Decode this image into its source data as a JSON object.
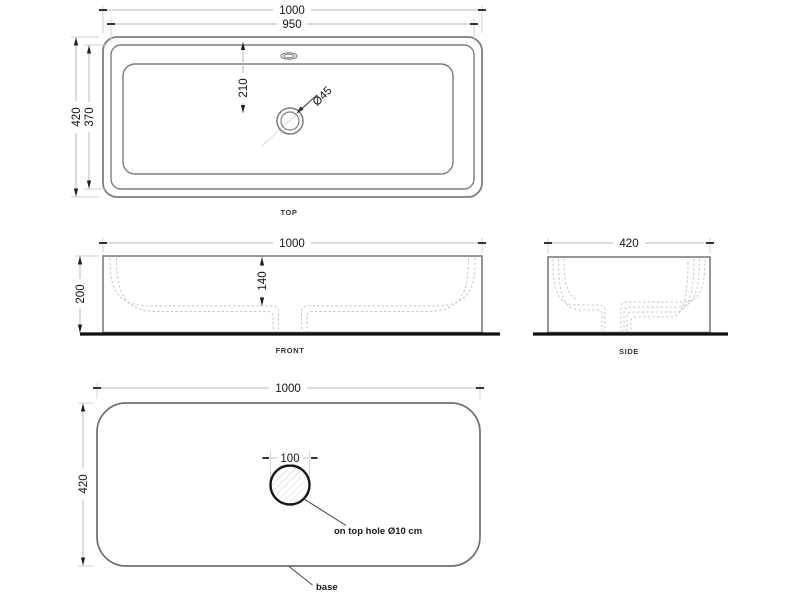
{
  "drawing_type": "basin technical drawing",
  "colors": {
    "outline_gray": "#7d7d7d",
    "dimension_line_gray": "#bababa",
    "hidden_line_gray": "#c6c6c6",
    "text_black": "#141414",
    "ground_line_black": "#111111",
    "background": "#ffffff"
  },
  "views": {
    "top": {
      "label": "TOP",
      "dimensions": {
        "outer_width": "1000",
        "rim_width": "950",
        "outer_depth": "420",
        "rim_depth": "370",
        "drain_offset": "210",
        "drain_diameter": "Ø45"
      }
    },
    "front": {
      "label": "FRONT",
      "dimensions": {
        "width": "1000",
        "height": "200",
        "basin_depth": "140"
      }
    },
    "side": {
      "label": "SIDE",
      "dimensions": {
        "depth": "420"
      }
    },
    "base": {
      "label": "base",
      "dimensions": {
        "width": "1000",
        "depth": "420",
        "hole_box": "100"
      },
      "note": "on top hole Ø10 cm"
    }
  }
}
